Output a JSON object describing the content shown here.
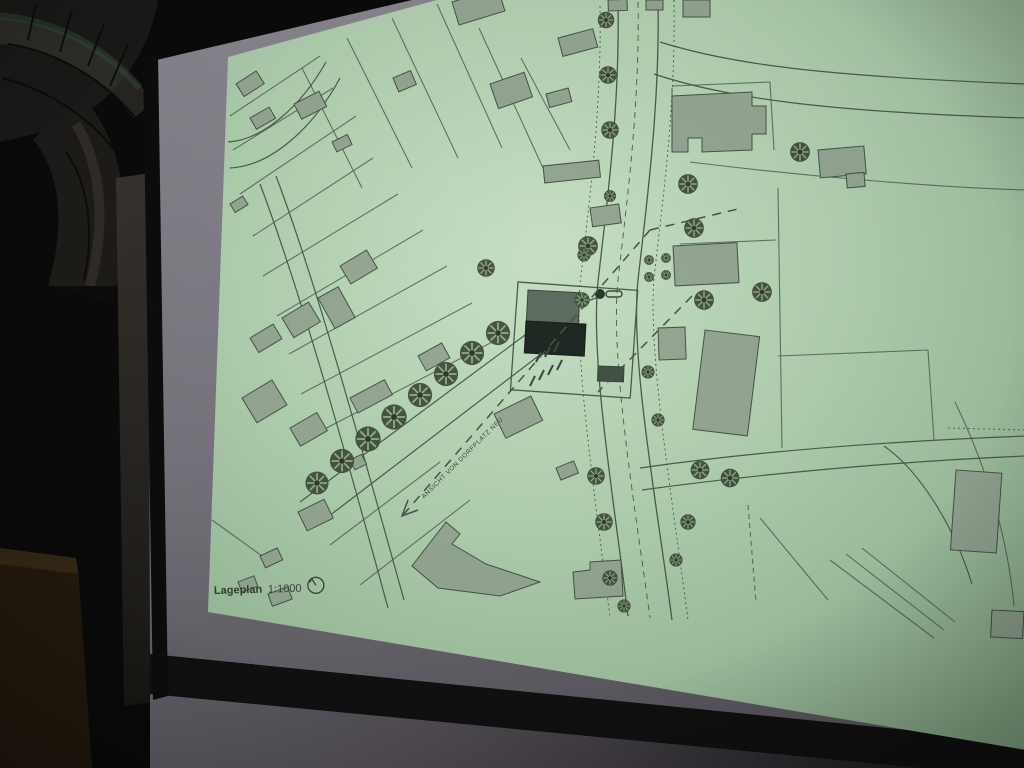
{
  "scene": {
    "kind": "photo of projection screen in dark room",
    "background_color": "#0a0a0b",
    "screen_color": "#837f88",
    "screen_frame_color": "#111111",
    "duct_color": "#1d1b19"
  },
  "map": {
    "caption": {
      "title": "Lageplan",
      "scale": "1:1000"
    },
    "annotation": {
      "text": "ANSICHT VON DORFPLATZ NEU"
    },
    "icons": {
      "north_arrow": "circle-with-north-hand",
      "tree": "radial-spoke-tree-symbol"
    },
    "colors": {
      "projection_bg": "#a9cbaa",
      "projection_center": "#c6dfc4",
      "line": "#4b5c4e",
      "building_fill": "#96a894",
      "project_building_roof": "#5d6e60",
      "project_building_dark": "#202823",
      "tree_fill": "#47553f"
    }
  }
}
